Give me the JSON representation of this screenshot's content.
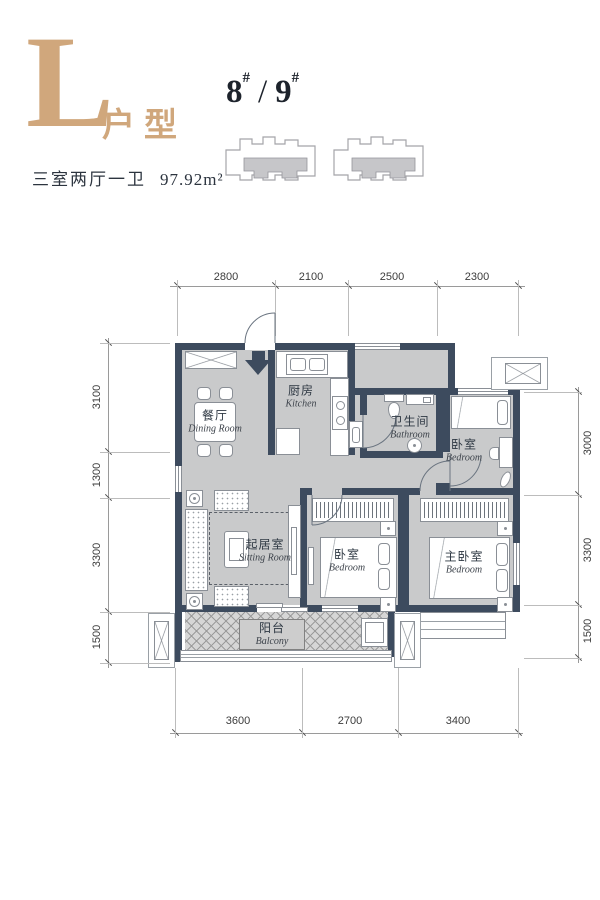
{
  "header": {
    "plan_letter": "L",
    "plan_type": "户型",
    "spec": "三室两厅一卫",
    "area": "97.92m²",
    "building_a": "8",
    "building_b": "9",
    "hash": "#",
    "separator": "/"
  },
  "rooms": {
    "dining": {
      "cn": "餐厅",
      "en": "Dining Room"
    },
    "kitchen": {
      "cn": "厨房",
      "en": "Kitchen"
    },
    "bathroom": {
      "cn": "卫生间",
      "en": "Bathroom"
    },
    "bedroom_top": {
      "cn": "卧室",
      "en": "Bedroom"
    },
    "sitting": {
      "cn": "起居室",
      "en": "Sitting Room"
    },
    "bedroom_mid": {
      "cn": "卧室",
      "en": "Bedroom"
    },
    "bedroom_master": {
      "cn": "主卧室",
      "en": "Bedroom"
    },
    "balcony": {
      "cn": "阳台",
      "en": "Balcony"
    }
  },
  "dimensions": {
    "top": [
      "2800",
      "2100",
      "2500",
      "2300"
    ],
    "left": [
      "3100",
      "1300",
      "3300",
      "1500"
    ],
    "right": [
      "3000",
      "3300",
      "1500"
    ],
    "bottom": [
      "3600",
      "2700",
      "3400"
    ]
  },
  "colors": {
    "accent": "#d0a77c",
    "wall": "#3d4b5e",
    "floor": "#c9cacb"
  }
}
